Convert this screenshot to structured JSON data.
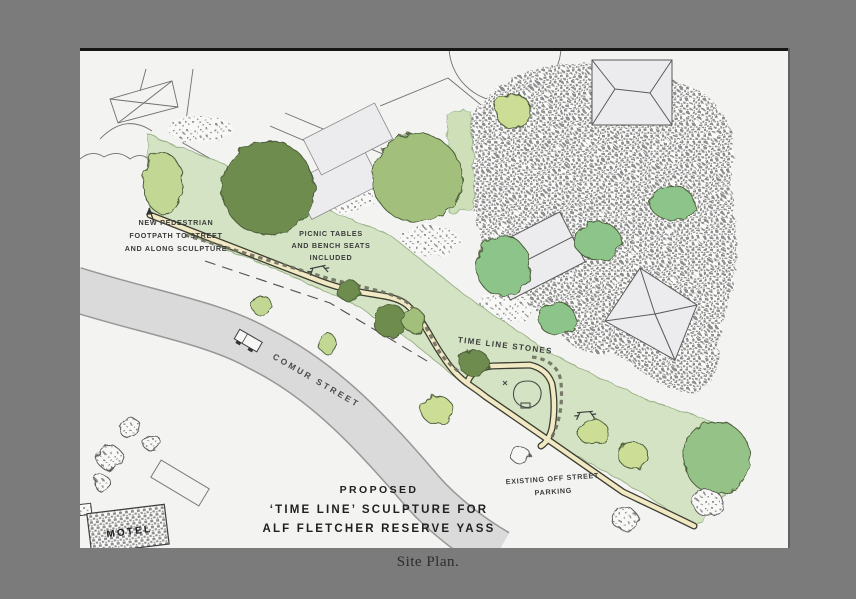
{
  "window": {
    "background_color": "#7b7b7b",
    "caption": "Site Plan."
  },
  "plan": {
    "annotations": {
      "footpath_note": {
        "line1": "NEW PEDESTRIAN",
        "line2": "FOOTPATH TO STREET",
        "line3": "AND ALONG SCULPTURE"
      },
      "picnic_note": {
        "line1": "PICNIC TABLES",
        "line2": "AND BENCH SEATS",
        "line3": "INCLUDED"
      },
      "timeline_stones_label": "TIME LINE STONES",
      "street_label": "COMUR STREET",
      "parking_note": {
        "line1": "EXISTING OFF STREET",
        "line2": "PARKING"
      },
      "motel_label": "MOTEL"
    },
    "title": {
      "line1": "PROPOSED",
      "line2": "‘TIME LINE’ SCULPTURE FOR",
      "line3": "ALF FLETCHER RESERVE YASS"
    },
    "colors": {
      "paper": "#f3f3f1",
      "reserve_green": "#d3e3c3",
      "road_gray": "#dadada",
      "road_edge": "#979797",
      "path_fill": "#f1e9c4",
      "path_edge": "#3c3c31",
      "tree_dark": "#6d8c4e",
      "tree_mid": "#a2c07c",
      "tree_bright": "#8cc48a",
      "tree_pale": "#c3d795",
      "tree_yellow": "#ccdd96",
      "tree_big_right": "#94c287",
      "building_fill": "#ececee",
      "stipple_gray": "#8d8d8d",
      "ink": "#3b3b3b",
      "title_ink": "#1f1f1f"
    }
  }
}
